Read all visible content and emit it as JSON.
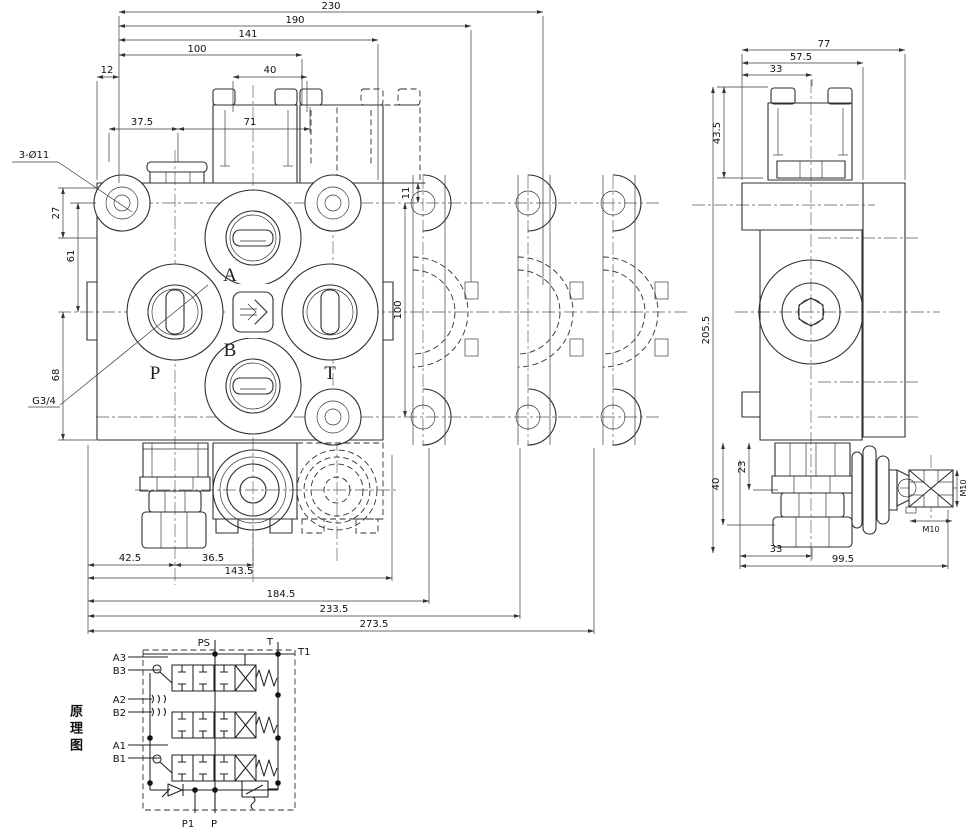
{
  "meta": {
    "kind": "hydraulic directional control valve engineering drawing",
    "line_color": "#2f2f2f",
    "bg": "#ffffff"
  },
  "front": {
    "dims": {
      "d230": "230",
      "d190": "190",
      "d141": "141",
      "d100": "100",
      "d40": "40",
      "d12": "12",
      "d37_5": "37.5",
      "d71": "71",
      "d11": "11",
      "v100": "100",
      "d27": "27",
      "d61": "61",
      "d68": "68",
      "d42_5": "42.5",
      "d36_5": "36.5",
      "d143_5": "143.5",
      "d184_5": "184.5",
      "d233_5": "233.5",
      "d273_5": "273.5"
    },
    "leaders": {
      "bolt_holes": "3-Ø11",
      "p_port_thread": "G3/4"
    },
    "ports": {
      "a": "A",
      "b": "B",
      "p": "P",
      "t": "T"
    }
  },
  "side": {
    "dims": {
      "d77": "77",
      "d57_5": "57.5",
      "d33": "33",
      "d43_5": "43.5",
      "d205_5": "205.5",
      "d23": "23",
      "d40": "40",
      "d33b": "33",
      "d99_5": "99.5",
      "m10_side": "M10",
      "m10_bottom": "M10"
    }
  },
  "schematic": {
    "title": "原理图",
    "labels": {
      "ps": "PS",
      "t": "T",
      "t1": "T1",
      "a3": "A3",
      "b3": "B3",
      "a2": "A2",
      "b2": "B2",
      "a1": "A1",
      "b1": "B1",
      "p1": "P1",
      "p": "P"
    }
  }
}
